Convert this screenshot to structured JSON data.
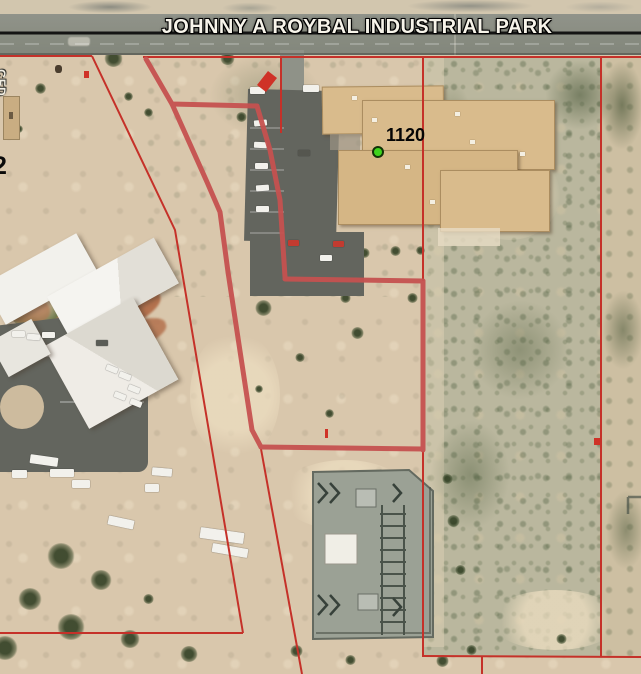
{
  "map": {
    "banner": {
      "title": "JOHNNY A ROYBAL INDUSTRIAL PARK"
    },
    "labels": {
      "parcel_number": "1120",
      "left_edge_partial_number": "2",
      "left_edge_vertical_text": "CFD"
    },
    "markers": {
      "parcel_point": {
        "label": "1120",
        "shape": "circle",
        "color": "#3fd41c",
        "outline": "#123307"
      },
      "flag_marker_color": "#cf3227"
    },
    "boundaries": {
      "selected_parcel_color": "#c65250",
      "parcel_line_color": "#c53129",
      "road_edge_line_color": "#141414"
    },
    "feature_names": [
      "industrial-park-road",
      "selected-parcel-outline",
      "adjacent-parcel-lines",
      "office-building-west",
      "industrial-building-1120",
      "electrical-substation",
      "parking-lot-west",
      "parking-lot-building-1120",
      "desert-terrain"
    ]
  }
}
